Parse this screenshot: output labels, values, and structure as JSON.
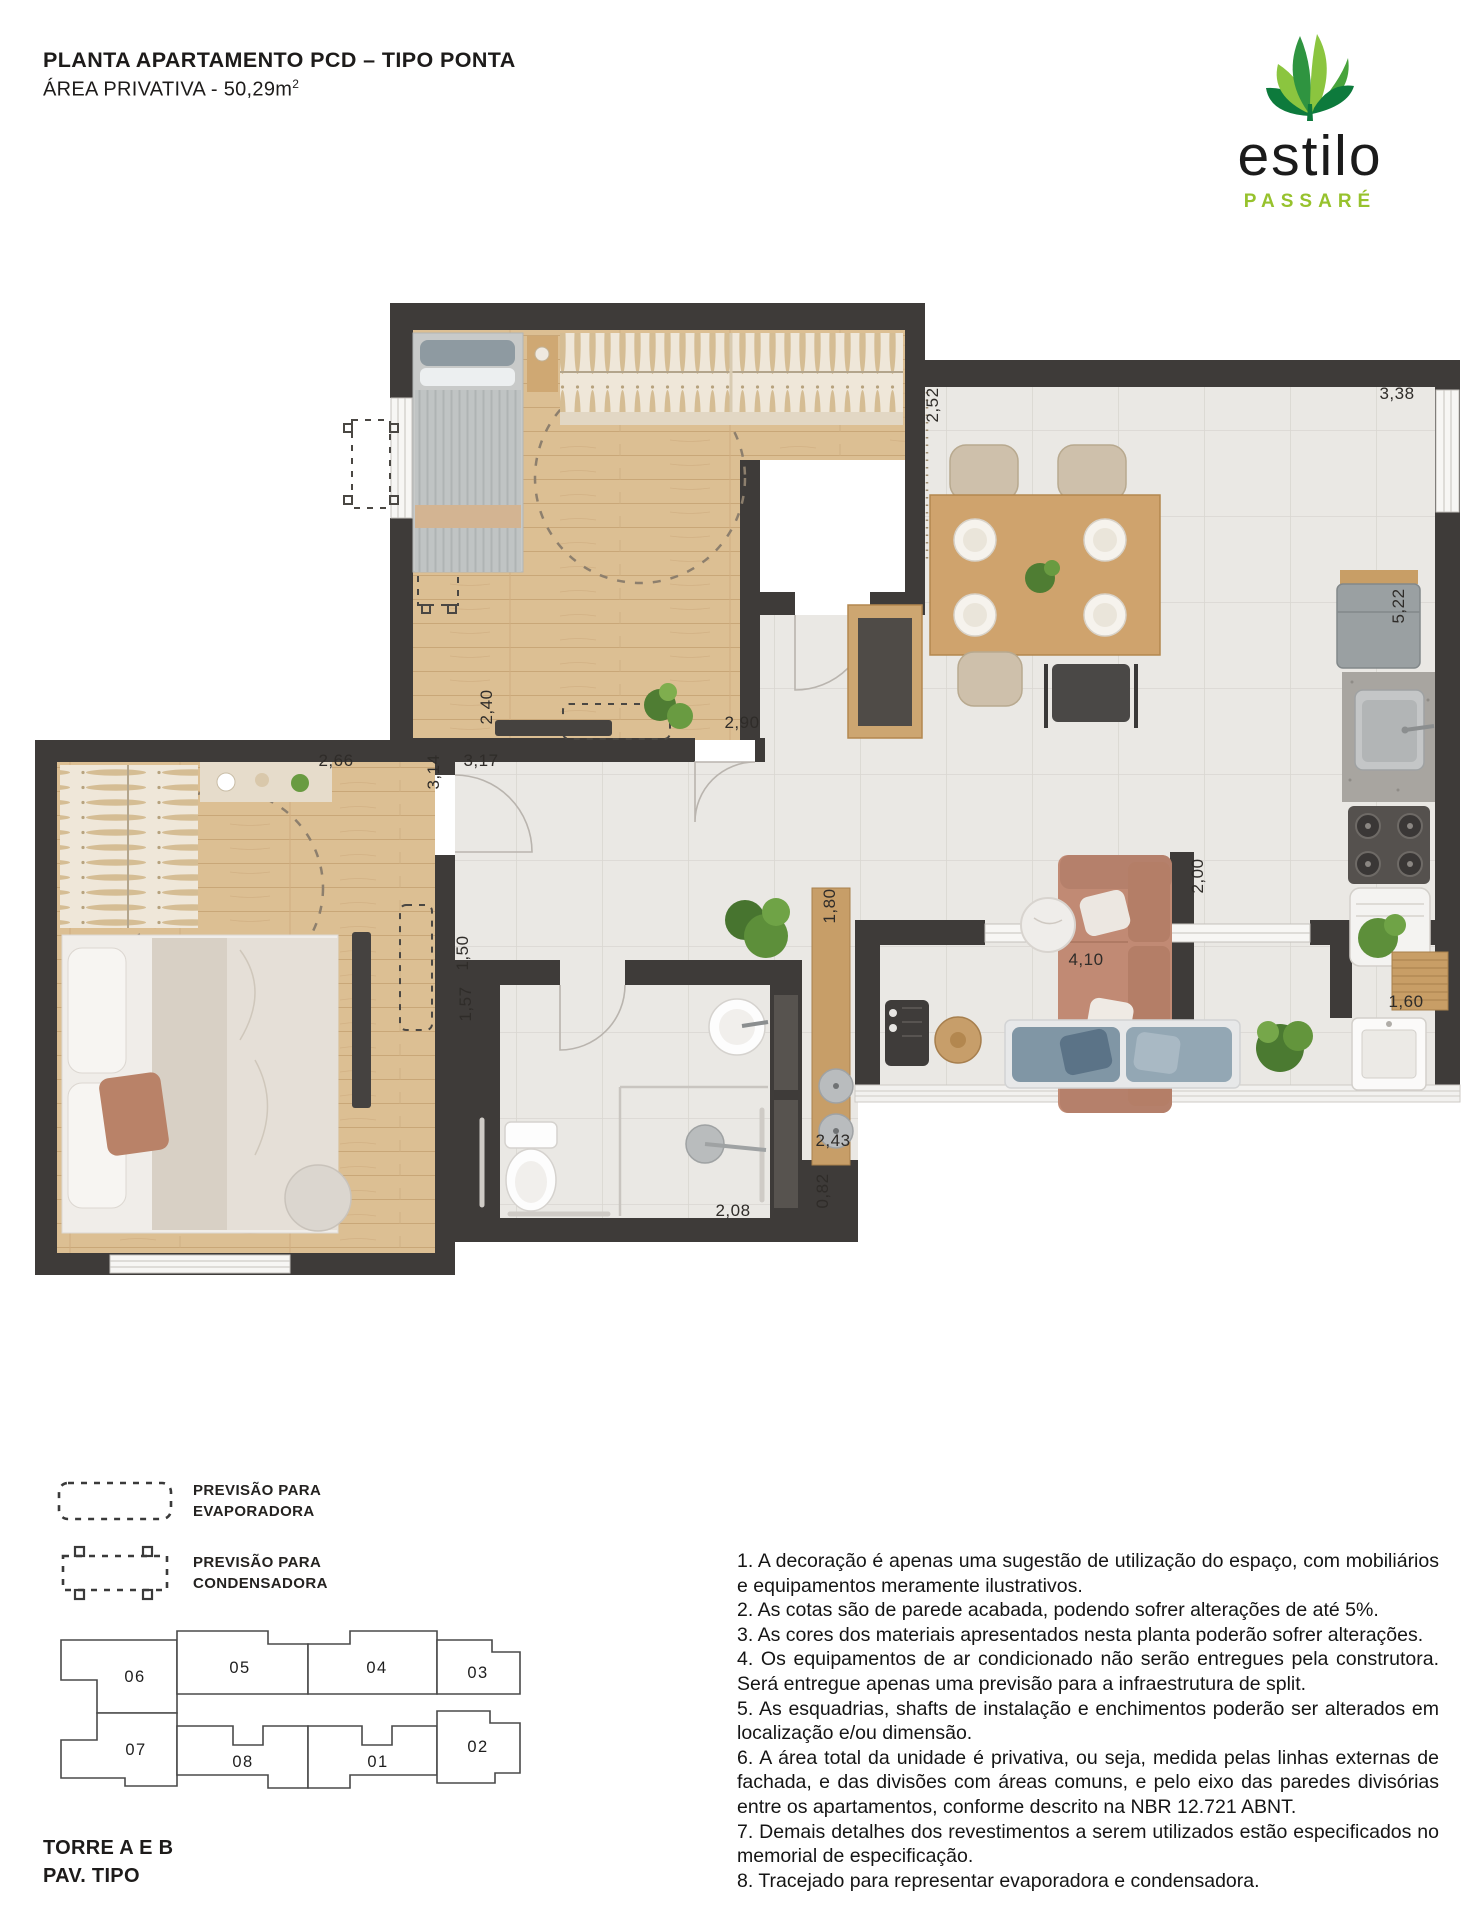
{
  "header": {
    "title": "PLANTA APARTAMENTO PCD – TIPO PONTA",
    "subtitle": "ÁREA PRIVATIVA - 50,29m",
    "subtitle_sup": "2"
  },
  "logo": {
    "brand": "estilo",
    "sub": "PASSARÉ"
  },
  "colors": {
    "brand_green": "#97c22d",
    "logo_green_dark": "#0d7a3c",
    "logo_green_mid": "#47a33b",
    "logo_green_light": "#8bc53f",
    "wall": "#3e3b39",
    "keyplan_highlight": "#b9b7b4"
  },
  "plan": {
    "dimensions": [
      {
        "label": "2,40",
        "x": 492,
        "y": 707,
        "rot": -90
      },
      {
        "label": "2,90",
        "x": 742,
        "y": 728,
        "rot": 0
      },
      {
        "label": "3,17",
        "x": 481,
        "y": 766,
        "rot": 0
      },
      {
        "label": "2,66",
        "x": 336,
        "y": 766,
        "rot": 0
      },
      {
        "label": "3,14",
        "x": 439,
        "y": 772,
        "rot": -90
      },
      {
        "label": "2,52",
        "x": 938,
        "y": 405,
        "rot": -90
      },
      {
        "label": "3,38",
        "x": 1397,
        "y": 399,
        "rot": 0
      },
      {
        "label": "5,22",
        "x": 1404,
        "y": 606,
        "rot": -90
      },
      {
        "label": "1,50",
        "x": 468,
        "y": 953,
        "rot": -90
      },
      {
        "label": "1,57",
        "x": 471,
        "y": 1004,
        "rot": -90
      },
      {
        "label": "1,80",
        "x": 835,
        "y": 906,
        "rot": -90
      },
      {
        "label": "2,00",
        "x": 1203,
        "y": 876,
        "rot": -90
      },
      {
        "label": "2,43",
        "x": 833,
        "y": 1146,
        "rot": 0
      },
      {
        "label": "0,82",
        "x": 828,
        "y": 1191,
        "rot": -90
      },
      {
        "label": "2,08",
        "x": 733,
        "y": 1216,
        "rot": 0
      },
      {
        "label": "1,60",
        "x": 1406,
        "y": 1007,
        "rot": 0
      },
      {
        "label": "4,10",
        "x": 1086,
        "y": 965,
        "rot": 0
      }
    ]
  },
  "legend": {
    "items": [
      {
        "label": "PREVISÃO PARA\nEVAPORADORA"
      },
      {
        "label": "PREVISÃO PARA\nCONDENSADORA"
      }
    ]
  },
  "keyplan": {
    "caption_line1": "TORRE A E B",
    "caption_line2": "PAV. TIPO",
    "units": [
      {
        "label": "06",
        "x": 95,
        "y": 54,
        "highlighted": false
      },
      {
        "label": "05",
        "x": 200,
        "y": 45,
        "highlighted": false
      },
      {
        "label": "04",
        "x": 337,
        "y": 45,
        "highlighted": false
      },
      {
        "label": "03",
        "x": 438,
        "y": 50,
        "highlighted": false
      },
      {
        "label": "07",
        "x": 96,
        "y": 127,
        "highlighted": true
      },
      {
        "label": "08",
        "x": 203,
        "y": 139,
        "highlighted": false
      },
      {
        "label": "01",
        "x": 338,
        "y": 139,
        "highlighted": false
      },
      {
        "label": "02",
        "x": 438,
        "y": 124,
        "highlighted": false
      }
    ]
  },
  "notes": [
    "1. A decoração é apenas uma sugestão de utilização do espaço, com mobiliários e equipamentos meramente ilustrativos.",
    "2. As cotas são de parede acabada, podendo sofrer alterações de até 5%.",
    "3. As cores dos materiais apresentados nesta planta poderão sofrer alterações.",
    "4. Os equipamentos de ar condicionado não serão entregues pela construtora. Será entregue apenas uma previsão para a infraestrutura de split.",
    "5. As esquadrias, shafts de instalação e enchimentos poderão ser alterados em localização e/ou dimensão.",
    "6. A área total da unidade é privativa, ou seja, medida pelas linhas externas de fachada, e das divisões com áreas comuns, e pelo eixo das paredes divisórias entre os apartamentos, conforme descrito na NBR 12.721 ABNT.",
    "7. Demais detalhes dos revestimentos a serem utilizados estão especificados no memorial de especificação.",
    "8. Tracejado para representar evaporadora e condensadora."
  ]
}
